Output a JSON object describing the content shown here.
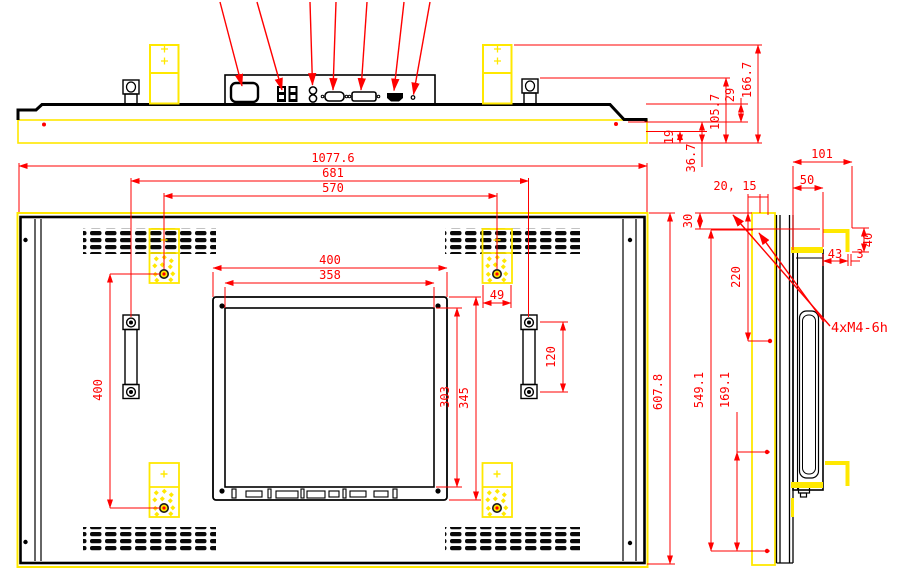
{
  "title": "Open-frame monitor dimension drawing",
  "colors": {
    "outline": "#000000",
    "dimension": "#ff0000",
    "bracket": "#ffe800",
    "background": "#ffffff"
  },
  "views": {
    "top": {
      "dims": {
        "step_height": "19",
        "bar_height": "29",
        "port_depth": "105.7",
        "bracket_depth": "166.7",
        "bezel_height": "36.7"
      }
    },
    "rear": {
      "dims": {
        "overall_width": "1077.6",
        "handle_span": "681",
        "vesa_span": "570",
        "cutout_width": "400",
        "panel_width": "358",
        "panel_height": "303",
        "cutout_height": "345",
        "bracket_offset": "49",
        "handle_pitch": "120",
        "vesa_vertical": "400",
        "overall_height": "607.8"
      }
    },
    "side": {
      "dims": {
        "depth_total": "101",
        "chassis_depth": "50",
        "panel_gap": "20, 15",
        "hook_inset": "30",
        "hook_span": "220",
        "hook_width": "43",
        "hook_thickness": "3",
        "hook_height": "40",
        "mount_height": "549.1",
        "hook_pitch": "169.1"
      },
      "note": "4xM4-6h"
    }
  }
}
